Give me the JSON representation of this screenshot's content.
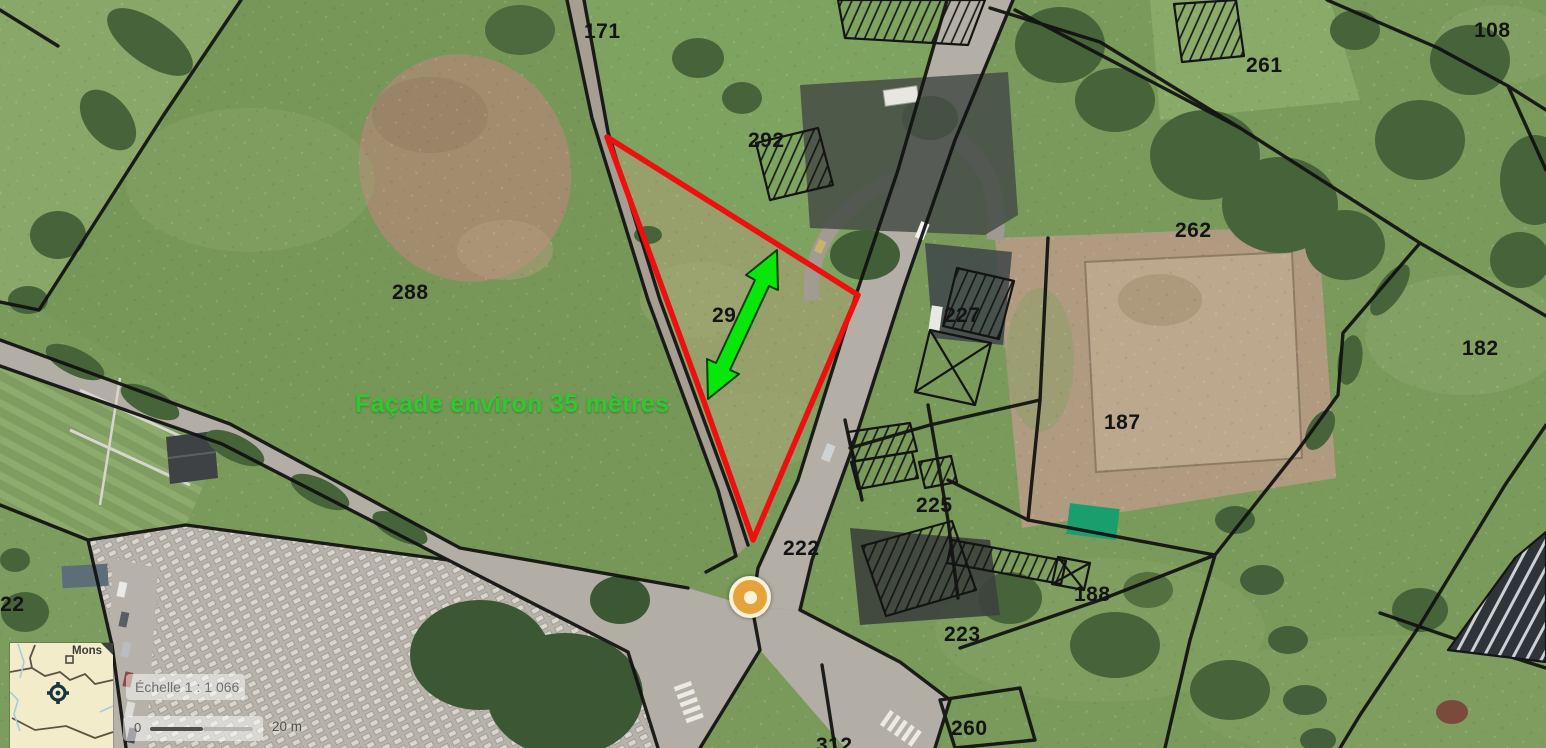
{
  "annotations": {
    "facade_text": "Façade environ 35 mètres",
    "facade_color": "#2fc82f",
    "arrow_color": "#09e609",
    "selection_color": "#ee0f0f"
  },
  "parcel_labels": [
    {
      "label": "171"
    },
    {
      "label": "292"
    },
    {
      "label": "288"
    },
    {
      "label": "29"
    },
    {
      "label": "261"
    },
    {
      "label": "108"
    },
    {
      "label": "262"
    },
    {
      "label": "182"
    },
    {
      "label": "227"
    },
    {
      "label": "187"
    },
    {
      "label": "225"
    },
    {
      "label": "222"
    },
    {
      "label": "188"
    },
    {
      "label": "223"
    },
    {
      "label": "260"
    },
    {
      "label": "312"
    },
    {
      "label": "322"
    }
  ],
  "marker": {
    "body_color": "#e6a33c",
    "ring_color": "#fcf2da"
  },
  "overview_map": {
    "place_label": "Mons"
  },
  "scale_control": {
    "scale_label": "Échelle 1 : 1 066",
    "bar_min": "0",
    "bar_max": "20 m"
  }
}
